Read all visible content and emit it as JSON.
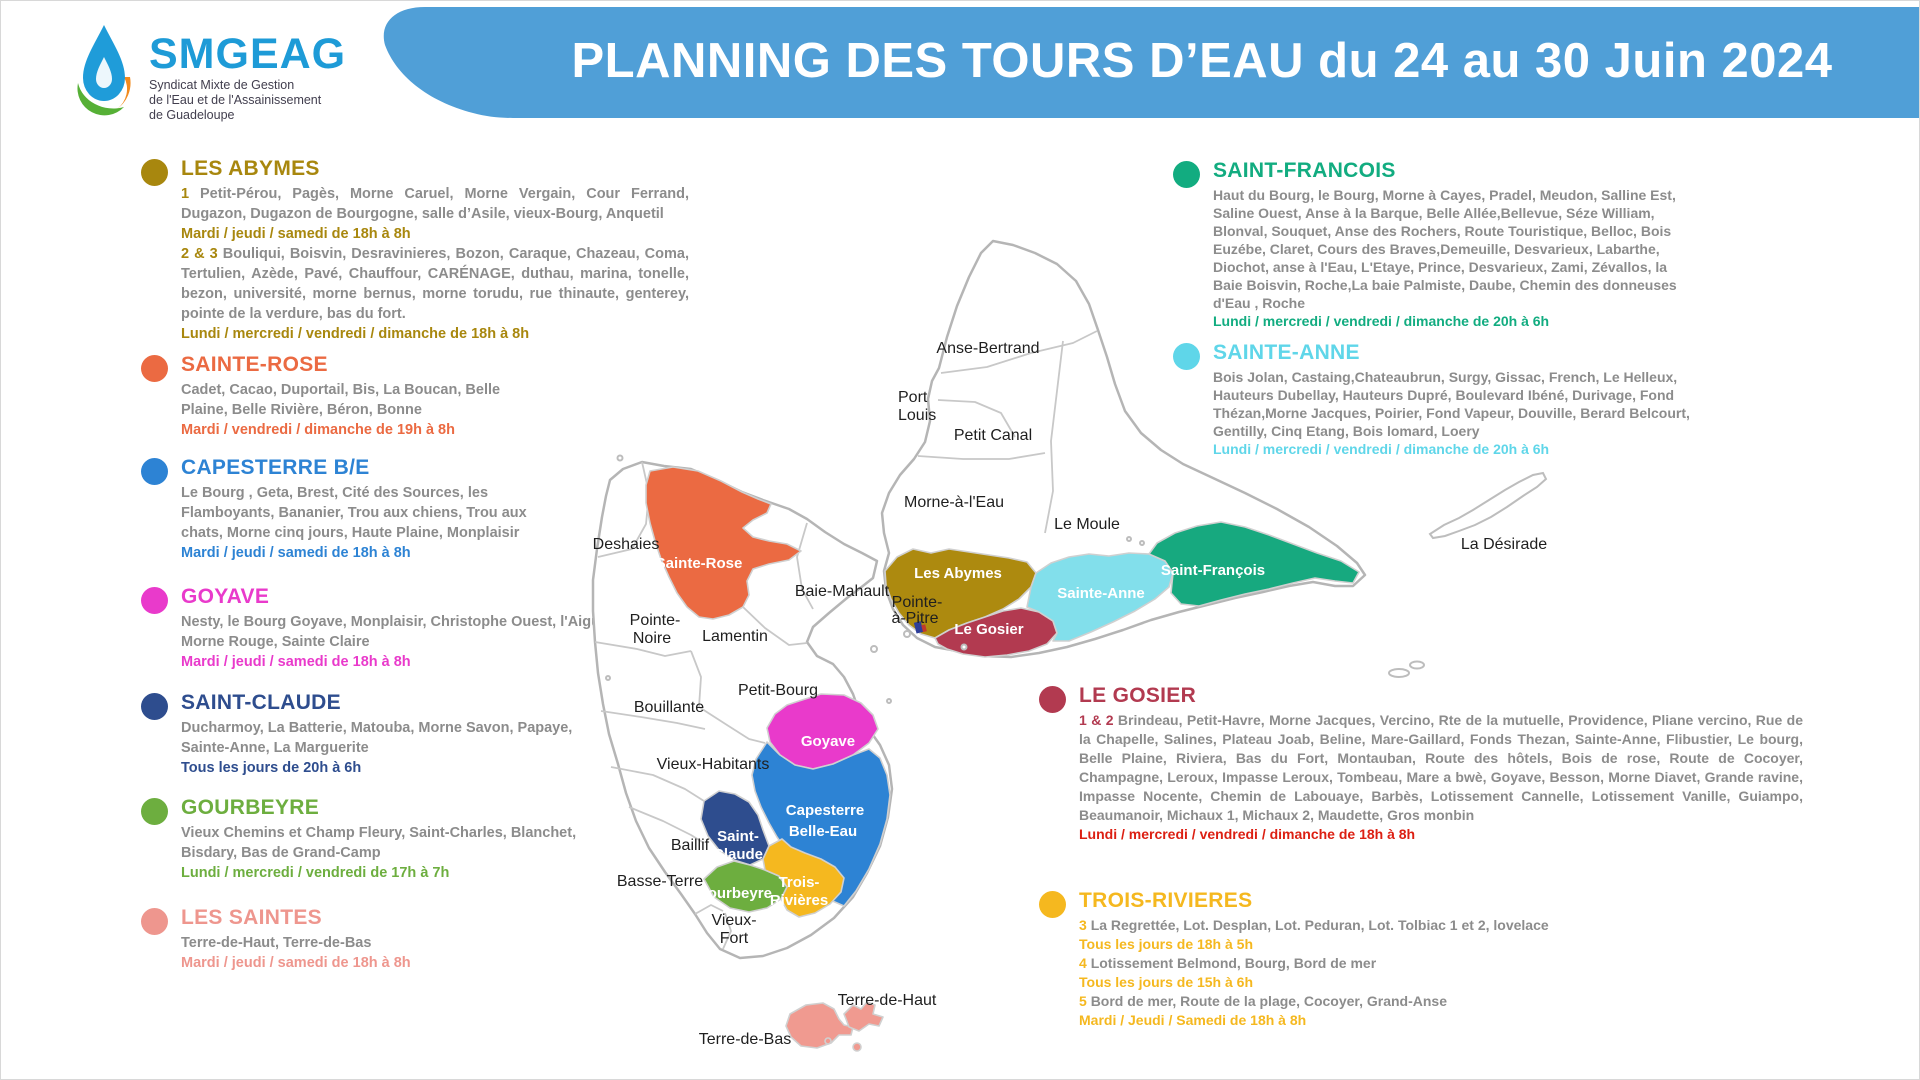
{
  "logo": {
    "name": "SMGEAG",
    "subtitle_lines": [
      "Syndicat Mixte de Gestion",
      "de l'Eau et de l'Assainissement",
      "de Guadeloupe"
    ]
  },
  "banner": {
    "title": "PLANNING DES TOURS D’EAU du 24 au 30 Juin 2024",
    "color": "#509FD7"
  },
  "sections": {
    "les_abymes": {
      "title": "LES ABYMES",
      "color": "#A8870E",
      "items": [
        {
          "type": "areas",
          "prefix": "1",
          "text": "Petit-Pérou,  Pagès, Morne Caruel, Morne Vergain,  Cour Ferrand,  Dugazon, Dugazon de Bourgogne, salle d’Asile, vieux-Bourg, Anquetil"
        },
        {
          "type": "schedule",
          "text": "Mardi / jeudi / samedi de 18h à 8h"
        },
        {
          "type": "areas",
          "prefix": "2 & 3",
          "text": "Bouliqui, Boisvin, Desravinieres, Bozon, Caraque, Chazeau, Coma, Tertulien, Azède, Pavé, Chauffour, CARÉNAGE,  duthau, marina, tonelle, bezon, université, morne bernus, morne torudu,  rue thinaute, genterey, pointe de la verdure, bas du fort."
        },
        {
          "type": "schedule",
          "text": "Lundi / mercredi / vendredi / dimanche de 18h à 8h"
        }
      ]
    },
    "sainte_rose": {
      "title": "SAINTE-ROSE",
      "color": "#EB6A42",
      "items": [
        {
          "type": "areas",
          "text": "Cadet, Cacao, Duportail, Bis, La Boucan, Belle Plaine, Belle Rivière, Béron, Bonne"
        },
        {
          "type": "schedule",
          "text": "Mardi / vendredi / dimanche de 19h à 8h"
        }
      ]
    },
    "capesterre": {
      "title": "CAPESTERRE B/E",
      "color": "#2D83D4",
      "items": [
        {
          "type": "areas",
          "text": "Le Bourg , Geta, Brest, Cité des Sources, les Flamboyants, Bananier, Trou aux chiens, Trou aux chats, Morne cinq jours, Haute Plaine, Monplaisir"
        },
        {
          "type": "schedule",
          "text": "Mardi / jeudi / samedi de 18h à 8h"
        }
      ]
    },
    "goyave": {
      "title": "GOYAVE",
      "color": "#E93ACB",
      "items": [
        {
          "type": "areas",
          "text": "Nesty, le Bourg Goyave, Monplaisir, Christophe Ouest, l'Aiguille, Morne Rouge, Sainte Claire"
        },
        {
          "type": "schedule",
          "text": "Mardi / jeudi / samedi de 18h à 8h"
        }
      ]
    },
    "saint_claude": {
      "title": "SAINT-CLAUDE",
      "color": "#2E4D8E",
      "items": [
        {
          "type": "areas",
          "text": "Ducharmoy, La Batterie, Matouba, Morne Savon, Papaye, Sainte-Anne, La Marguerite"
        },
        {
          "type": "schedule",
          "text": "Tous les jours de 20h à 6h"
        }
      ]
    },
    "gourbeyre": {
      "title": "GOURBEYRE",
      "color": "#6DAE3F",
      "items": [
        {
          "type": "areas",
          "text": "Vieux Chemins et Champ Fleury,  Saint-Charles, Blanchet, Bisdary, Bas de Grand-Camp"
        },
        {
          "type": "schedule",
          "text": "Lundi / mercredi / vendredi de 17h à 7h"
        }
      ]
    },
    "les_saintes": {
      "title": "LES SAINTES",
      "color": "#EE968E",
      "items": [
        {
          "type": "areas",
          "text": "Terre-de-Haut, Terre-de-Bas"
        },
        {
          "type": "schedule",
          "text": "Mardi / jeudi / samedi de 18h à 8h"
        }
      ]
    },
    "saint_francois": {
      "title": "SAINT-FRANCOIS",
      "color": "#12AC80",
      "items": [
        {
          "type": "areas",
          "text": "Haut du Bourg, le Bourg, Morne à Cayes, Pradel, Meudon, Salline Est, Saline Ouest, Anse à la Barque, Belle Allée,Bellevue, Séze William, Blonval, Souquet, Anse des Rochers, Route Touristique, Belloc, Bois Euzébe, Claret, Cours des Braves,Demeuille, Desvarieux, Labarthe, Diochot, anse à l'Eau,  L'Etaye, Prince, Desvarieux, Zami, Zévallos,  la Baie Boisvin, Roche,La baie Palmiste, Daube, Chemin des donneuses d'Eau , Roche"
        },
        {
          "type": "schedule",
          "text": "Lundi / mercredi / vendredi / dimanche de 20h à 6h"
        }
      ]
    },
    "sainte_anne": {
      "title": "SAINTE-ANNE",
      "color": "#5FD6E9",
      "items": [
        {
          "type": "areas",
          "text": "Bois Jolan, Castaing,Chateaubrun, Surgy, Gissac, French,  Le Helleux, Hauteurs Dubellay, Hauteurs Dupré, Boulevard Ibéné, Durivage, Fond Thézan,Morne Jacques, Poirier, Fond Vapeur, Douville, Berard Belcourt, Gentilly, Cinq Etang, Bois lomard, Loery"
        },
        {
          "type": "schedule",
          "text": "Lundi / mercredi / vendredi / dimanche de 20h à 6h"
        }
      ]
    },
    "le_gosier": {
      "title": "LE GOSIER",
      "color": "#B23A50",
      "items": [
        {
          "type": "areas",
          "prefix": "1 & 2",
          "text": "Brindeau, Petit-Havre, Morne Jacques, Vercino, Rte de la mutuelle, Providence, Pliane vercino, Rue de la Chapelle, Salines, Plateau Joab,  Beline, Mare-Gaillard, Fonds Thezan, Sainte-Anne, Flibustier, Le bourg, Belle Plaine, Riviera, Bas du Fort, Montauban, Route des hôtels, Bois de rose, Route de Cocoyer, Champagne, Leroux, Impasse Leroux, Tombeau, Mare a bwè, Goyave, Besson, Morne Diavet, Grande ravine, Impasse Nocente, Chemin de Labouaye, Barbès, Lotissement Cannelle, Lotissement Vanille, Guiampo, Beaumanoir, Michaux 1, Michaux 2, Maudette, Gros monbin"
        },
        {
          "type": "schedule",
          "color": "#DC1F12",
          "text": "Lundi / mercredi / vendredi / dimanche de 18h à 8h"
        }
      ]
    },
    "trois_rivieres": {
      "title": "TROIS-RIVIERES",
      "color": "#F5B81F",
      "items": [
        {
          "type": "areas",
          "prefix": "3",
          "text": "La Regrettée, Lot. Desplan, Lot. Peduran, Lot. Tolbiac 1 et 2, lovelace"
        },
        {
          "type": "schedule",
          "text": "Tous les jours de 18h à 5h"
        },
        {
          "type": "areas",
          "prefix": "4",
          "text": "Lotissement Belmond, Bourg, Bord de mer"
        },
        {
          "type": "schedule",
          "text": "Tous les jours de 15h à 6h"
        },
        {
          "type": "areas",
          "prefix": "5",
          "text": "Bord de mer, Route de la plage, Cocoyer, Grand-Anse"
        },
        {
          "type": "schedule",
          "text": "Mardi / Jeudi / Samedi de 18h à 8h"
        }
      ]
    }
  },
  "map": {
    "labels": {
      "anse_bertrand": "Anse-Bertrand",
      "port": "Port",
      "louis": "Louis",
      "petit_canal": "Petit Canal",
      "morne_a_leau": "Morne-à-l'Eau",
      "le_moule": "Le Moule",
      "baie_mahault": "Baie-Mahault",
      "pointe_a_pitre_1": "Pointe-",
      "pointe_a_pitre_2": "à-Pitre",
      "deshaies": "Deshaies",
      "pointe_noire_1": "Pointe-",
      "pointe_noire_2": "Noire",
      "lamentin": "Lamentin",
      "petit_bourg": "Petit-Bourg",
      "bouillante": "Bouillante",
      "vieux_habitants": "Vieux-Habitants",
      "baillif": "Baillif",
      "basse_terre": "Basse-Terre",
      "vieux_fort_1": "Vieux-",
      "vieux_fort_2": "Fort",
      "terre_de_haut": "Terre-de-Haut",
      "terre_de_bas": "Terre-de-Bas",
      "la_desirade": "La Désirade"
    },
    "regions": {
      "sainte_rose": {
        "label": "Sainte-Rose",
        "color": "#EB6A42"
      },
      "les_abymes": {
        "label": "Les Abymes",
        "color": "#AD8A0F"
      },
      "sainte_anne": {
        "label": "Sainte-Anne",
        "color": "#82DFEB"
      },
      "saint_francois": {
        "label": "Saint-François",
        "color": "#17A97F"
      },
      "le_gosier": {
        "label": "Le Gosier",
        "color": "#B23A50"
      },
      "goyave": {
        "label": "Goyave",
        "color": "#E93ACB"
      },
      "capesterre": {
        "label_1": "Capesterre",
        "label_2": "Belle-Eau",
        "color": "#2D83D4"
      },
      "saint_claude": {
        "label_1": "Saint-",
        "label_2": "Claude",
        "color": "#2E4D8E"
      },
      "gourbeyre": {
        "label": "Gourbeyre",
        "color": "#6DAE3F"
      },
      "trois_rivieres": {
        "label_1": "Trois-",
        "label_2": "Rivières",
        "color": "#F5B81F"
      },
      "les_saintes": {
        "color": "#F09A90"
      }
    }
  }
}
